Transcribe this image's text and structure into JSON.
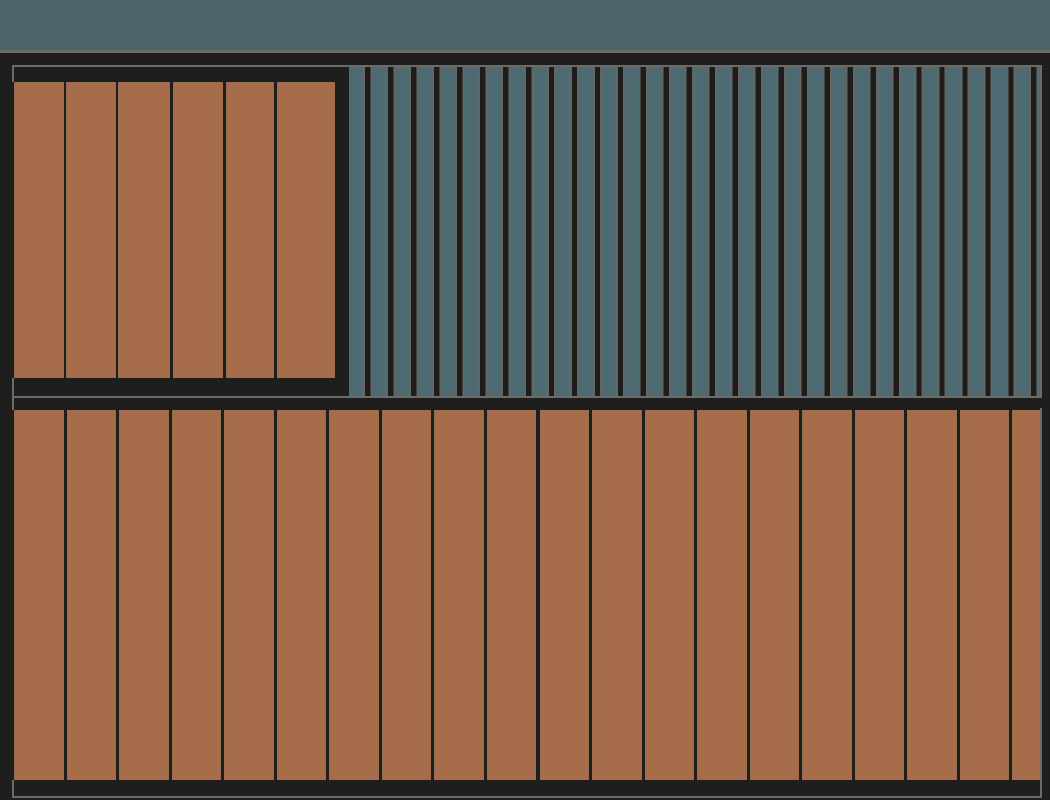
{
  "scene": {
    "description": "Flat architectural elevation render: dark-framed facade with terracotta vertical wood plank cladding and a blue-grey vertical slat screen under a slate top band",
    "canvas": {
      "width_px": 1050,
      "height_px": 800
    }
  },
  "palette": {
    "background_dark": "#1e1e1c",
    "top_band_slate": "#4d666d",
    "slat_blue_grey": "#4e6a72",
    "plank_brown": "#a76d4a",
    "divider_grey": "#6e6a66",
    "frame_outline_grey": "#6b6b6b",
    "slat_edge_grey": "#6b6560",
    "gap_dark": "#1c1c1a",
    "plank_edge_highlight": "rgba(124,110,96,0.25)"
  },
  "top_band": {
    "x": 0,
    "y": 0,
    "width": 1050,
    "height": 50
  },
  "top_divider": {
    "x": 0,
    "y": 50,
    "width": 1050,
    "height": 3
  },
  "upper_section": {
    "x": 12,
    "y": 65,
    "width": 1030,
    "height": 333,
    "border_px": 2,
    "left_panel": {
      "plank_top_y": 82,
      "plank_height": 296,
      "plank_count": 6,
      "planks": [
        {
          "left": 14,
          "width": 50
        },
        {
          "left": 66,
          "width": 49.5
        },
        {
          "left": 118,
          "width": 52
        },
        {
          "left": 173,
          "width": 49.5
        },
        {
          "left": 225.5,
          "width": 48
        },
        {
          "left": 277,
          "width": 57.5
        }
      ]
    },
    "slat_screen": {
      "left": 349,
      "top": 67,
      "width": 691,
      "height": 329,
      "slat_count": 30,
      "period": 22.97,
      "slat_width": 14.6,
      "edge_width": 1.5,
      "gap_width": 5.37
    }
  },
  "frame_joint": {
    "x": 12,
    "y": 396,
    "width": 2,
    "height": 14
  },
  "lower_section": {
    "x": 12,
    "y": 408,
    "width": 1030,
    "height": 390,
    "border_px": 2,
    "planks": {
      "count": 20,
      "first_left": 14,
      "period": 52.55,
      "width": 49.5,
      "top_y": 410,
      "height": 370
    }
  },
  "border_covers": [
    {
      "x": 12,
      "y": 82,
      "width": 2,
      "height": 296
    },
    {
      "x": 12,
      "y": 410,
      "width": 2,
      "height": 370
    }
  ]
}
